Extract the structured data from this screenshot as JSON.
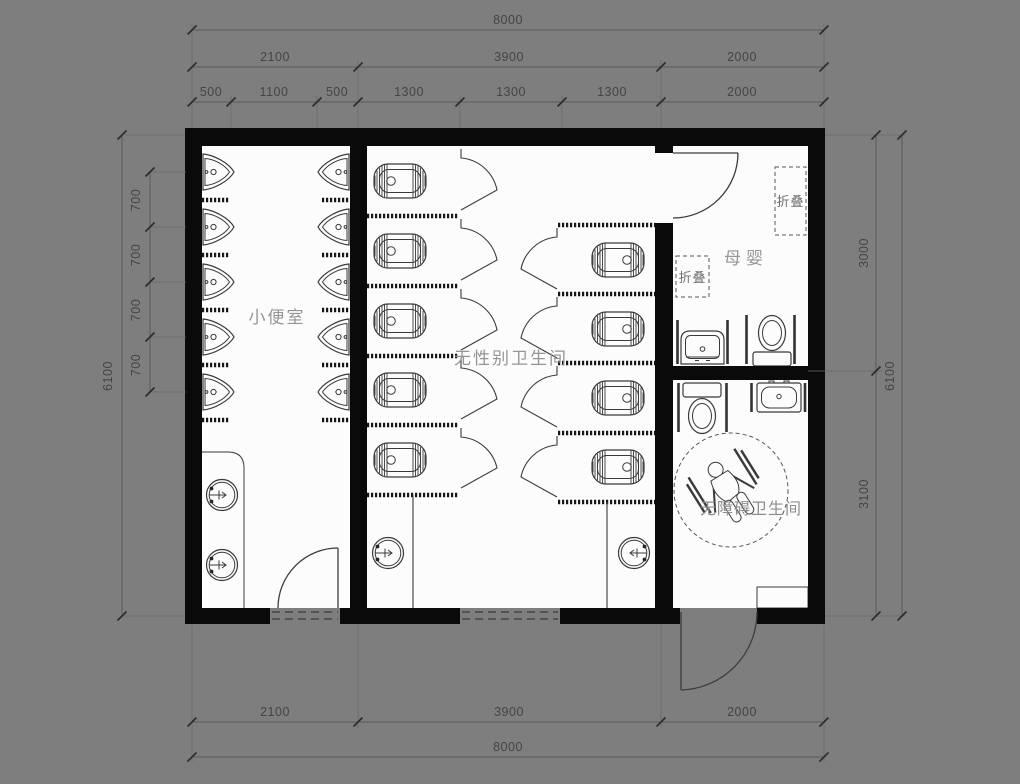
{
  "drawing": {
    "background": "#7e7e7e",
    "paper_color": "#fcfcfc",
    "wall_color": "#0a0a0a",
    "rooms": {
      "urinal_room": "小便室",
      "unisex_toilet": "无性别卫生间",
      "mother_baby": "母婴",
      "accessible_toilet": "无障碍卫生间",
      "folding_table": "折叠"
    },
    "dimensions": {
      "top_total": "8000",
      "top_row2": [
        "2100",
        "3900",
        "2000"
      ],
      "top_row3": [
        "500",
        "1100",
        "500",
        "1300",
        "1300",
        "1300",
        "2000"
      ],
      "left_segments": [
        "700",
        "700",
        "700",
        "700"
      ],
      "left_total": "6100",
      "right_segments": [
        "3000",
        "3100"
      ],
      "right_total": "6100",
      "bottom_row": [
        "2100",
        "3900",
        "2000"
      ],
      "bottom_total": "8000"
    }
  }
}
